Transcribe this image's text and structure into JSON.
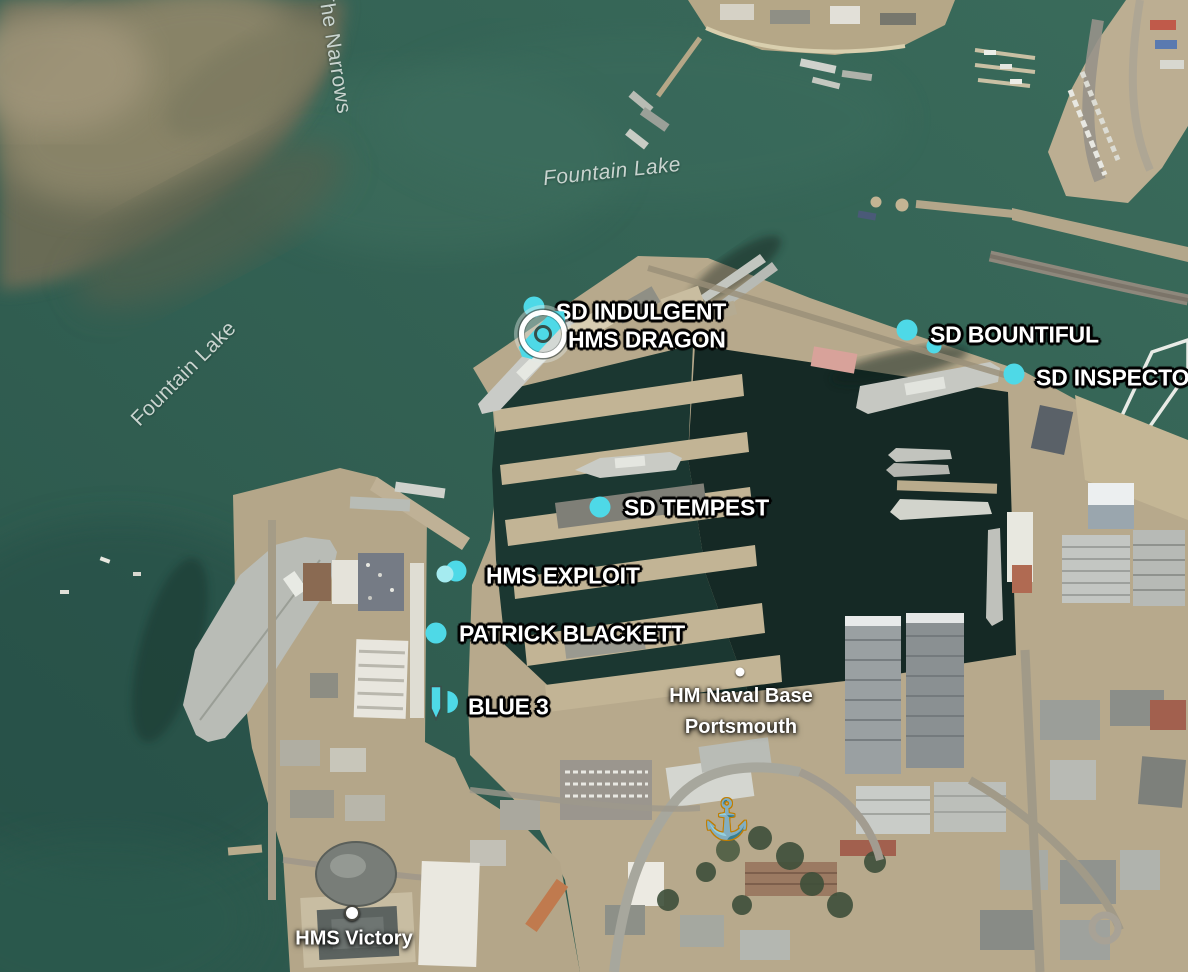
{
  "map": {
    "type": "satellite",
    "location": "HM Naval Base Portsmouth",
    "colors": {
      "marker_cyan": "#4ED9E7",
      "water_label": "#C9D4CF",
      "anchor_yellow": "#FFD22E"
    }
  },
  "water_labels": [
    {
      "text": "The Narrows",
      "x": 334,
      "y": 52,
      "rotation": 81
    },
    {
      "text": "Fountain Lake",
      "x": 612,
      "y": 172,
      "rotation": -6
    },
    {
      "text": "Fountain Lake",
      "x": 184,
      "y": 374,
      "rotation": -45
    }
  ],
  "place_markers": {
    "naval_base": {
      "line1": "HM Naval Base",
      "line2": "Portsmouth",
      "label": {
        "x": 741,
        "y": 712
      },
      "dot": {
        "x": 740,
        "y": 672
      }
    },
    "hms_victory": {
      "text": "HMS Victory",
      "label": {
        "x": 354,
        "y": 939
      },
      "dot": {
        "x": 352,
        "y": 913
      }
    }
  },
  "anchor_icon": {
    "glyph": "⚓",
    "x": 727,
    "y": 820
  },
  "vessels": [
    {
      "name": "SD INDULGENT",
      "marker_style": "dot",
      "icon": {
        "x": 534,
        "y": 307
      },
      "label": {
        "x": 556,
        "y": 312
      }
    },
    {
      "name": "HMS DRAGON",
      "marker_style": "selected-ship",
      "icon": {
        "x": 543,
        "y": 334
      },
      "label": {
        "x": 568,
        "y": 340
      }
    },
    {
      "name": "SD BOUNTIFUL",
      "marker_style": "dot",
      "icon": {
        "x": 907,
        "y": 330
      },
      "label": {
        "x": 930,
        "y": 335
      }
    },
    {
      "name": "SD INSPECTOR",
      "marker_style": "dot",
      "icon": {
        "x": 1014,
        "y": 374
      },
      "label": {
        "x": 1036,
        "y": 378
      }
    },
    {
      "name": "SD TEMPEST",
      "marker_style": "dot",
      "icon": {
        "x": 600,
        "y": 507
      },
      "label": {
        "x": 624,
        "y": 508
      }
    },
    {
      "name": "HMS EXPLOIT",
      "marker_style": "dot-double",
      "icon": {
        "x": 456,
        "y": 571
      },
      "label": {
        "x": 486,
        "y": 576
      }
    },
    {
      "name": "PATRICK BLACKETT",
      "marker_style": "dot",
      "icon": {
        "x": 436,
        "y": 633
      },
      "label": {
        "x": 459,
        "y": 634
      }
    },
    {
      "name": "BLUE 3",
      "marker_style": "ship-shape",
      "icon": {
        "x": 438,
        "y": 702
      },
      "label": {
        "x": 468,
        "y": 707
      }
    }
  ],
  "unlabeled_markers": [
    {
      "x": 934,
      "y": 346
    }
  ]
}
